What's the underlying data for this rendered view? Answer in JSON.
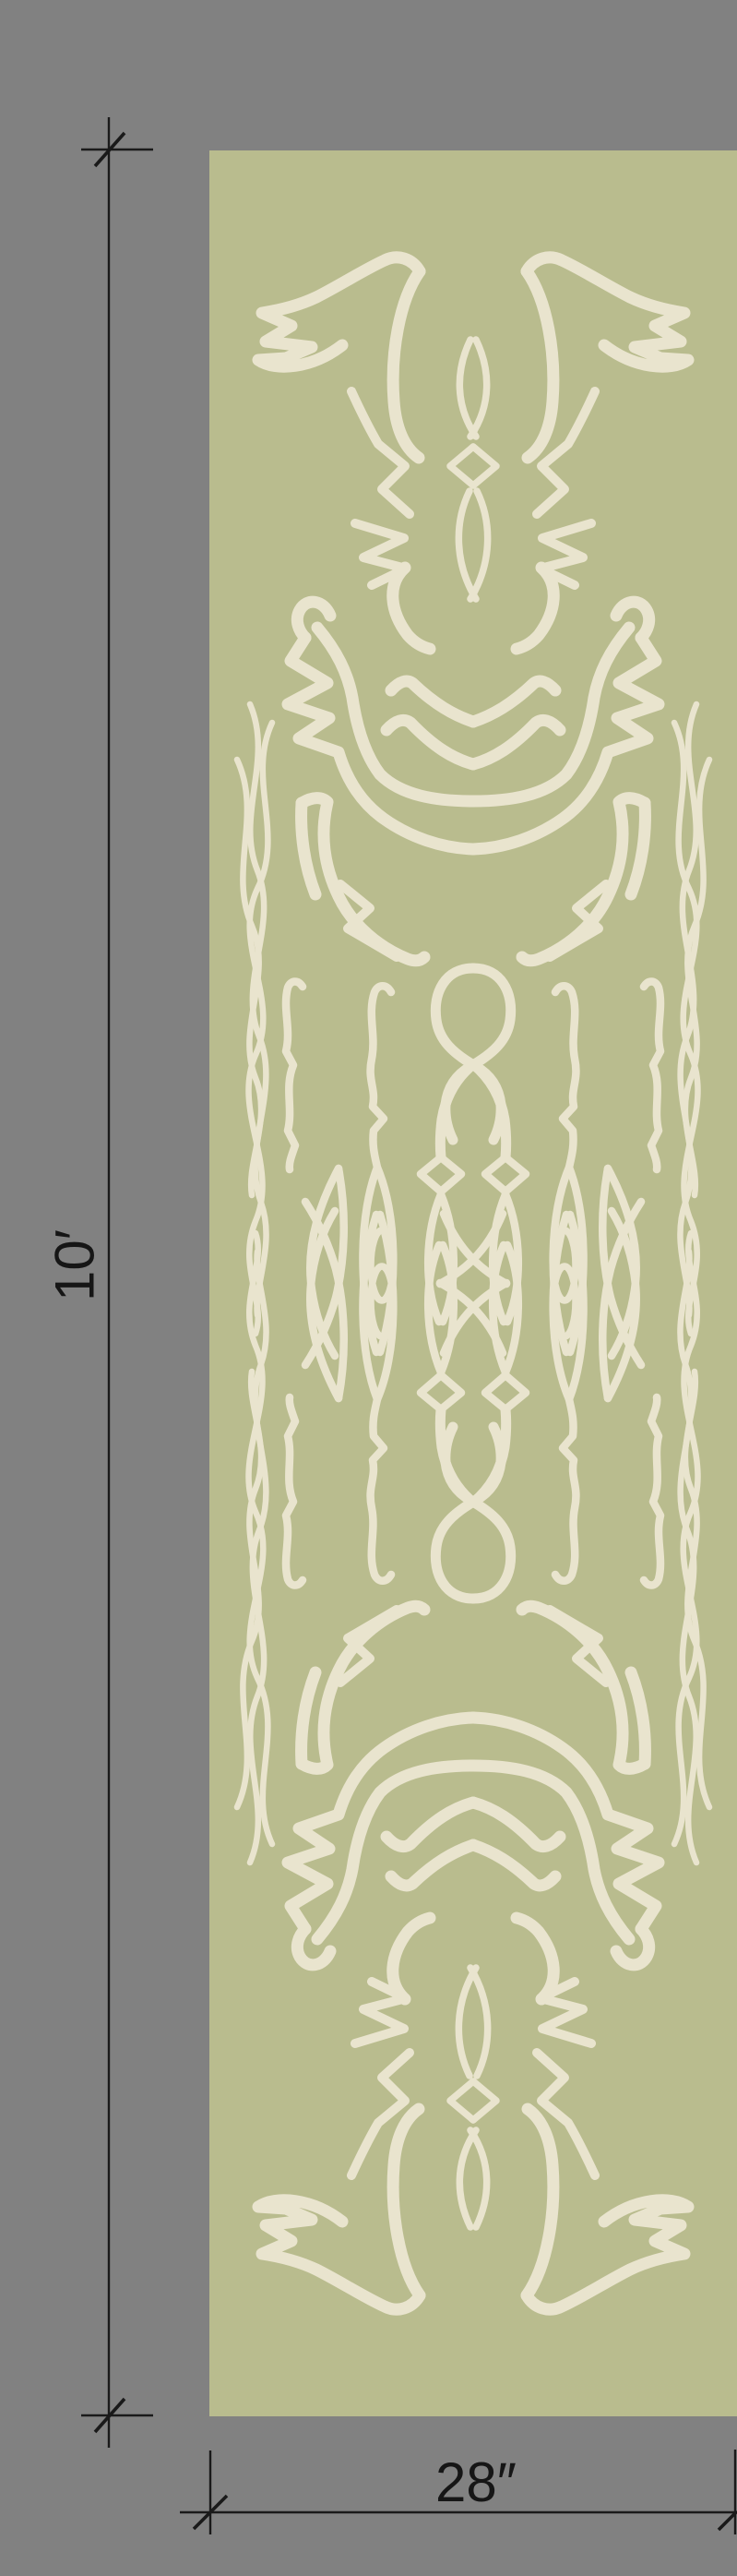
{
  "artwork": {
    "kind": "wallpaper panel mockup with dimension annotations",
    "background_color": "#818181",
    "panel_color": "#b9bc8e",
    "motif_color": "#e9e4ce",
    "annotation_color": "#1a1a1a"
  },
  "annotations": {
    "height_label": "10′",
    "width_label": "28″"
  }
}
